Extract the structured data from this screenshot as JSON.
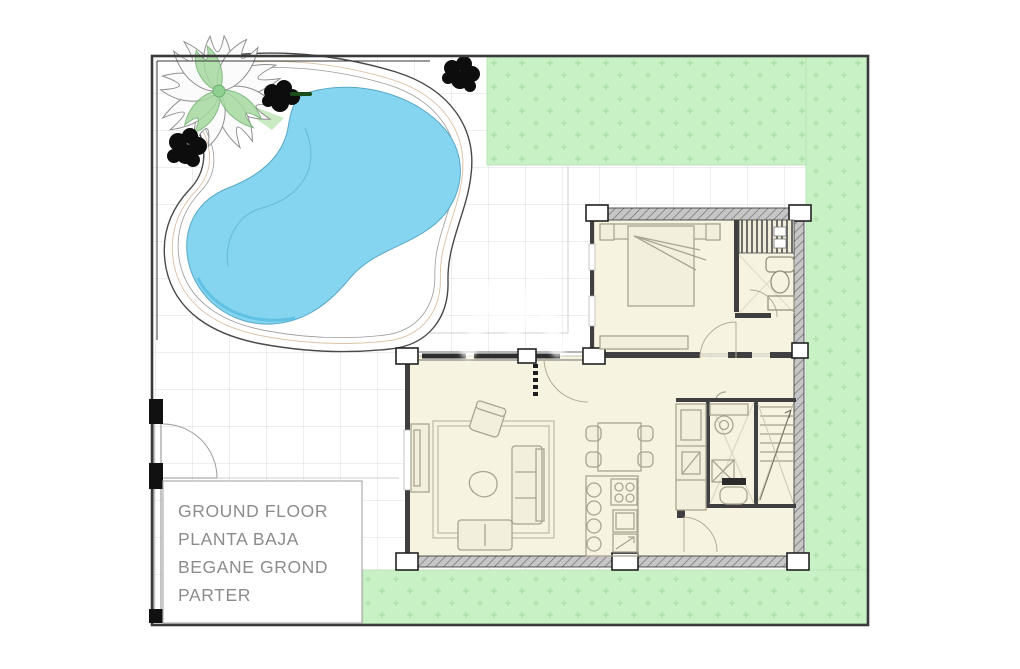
{
  "title_block": {
    "lines": [
      "GROUND FLOOR",
      "PLANTA BAJA",
      "BEGANE GROND",
      "PARTER"
    ]
  },
  "colors": {
    "pool_water": "#85d5f1",
    "pool_edge_shade": "#57bce0",
    "grass": "#c9f1c6",
    "grass_mark": "#9fd89c",
    "floor_cream": "#f6f3e0",
    "wall_dark": "#3f3f3f",
    "furniture_line": "#a9a591",
    "site_border": "#3a3a3a",
    "tile_grid": "#dedede",
    "label_text": "#8c8c8c",
    "palm_leaf_green": "#8fcf8f",
    "bush_black": "#0d0d0d"
  },
  "legend": {
    "drawing_type": "ground floor site plan",
    "features": [
      "swimming-pool",
      "lawn",
      "terrace",
      "bedroom",
      "bathroom",
      "living-room",
      "kitchen",
      "dining",
      "stairs",
      "entrance-gate",
      "palm-tree",
      "bushes"
    ]
  }
}
